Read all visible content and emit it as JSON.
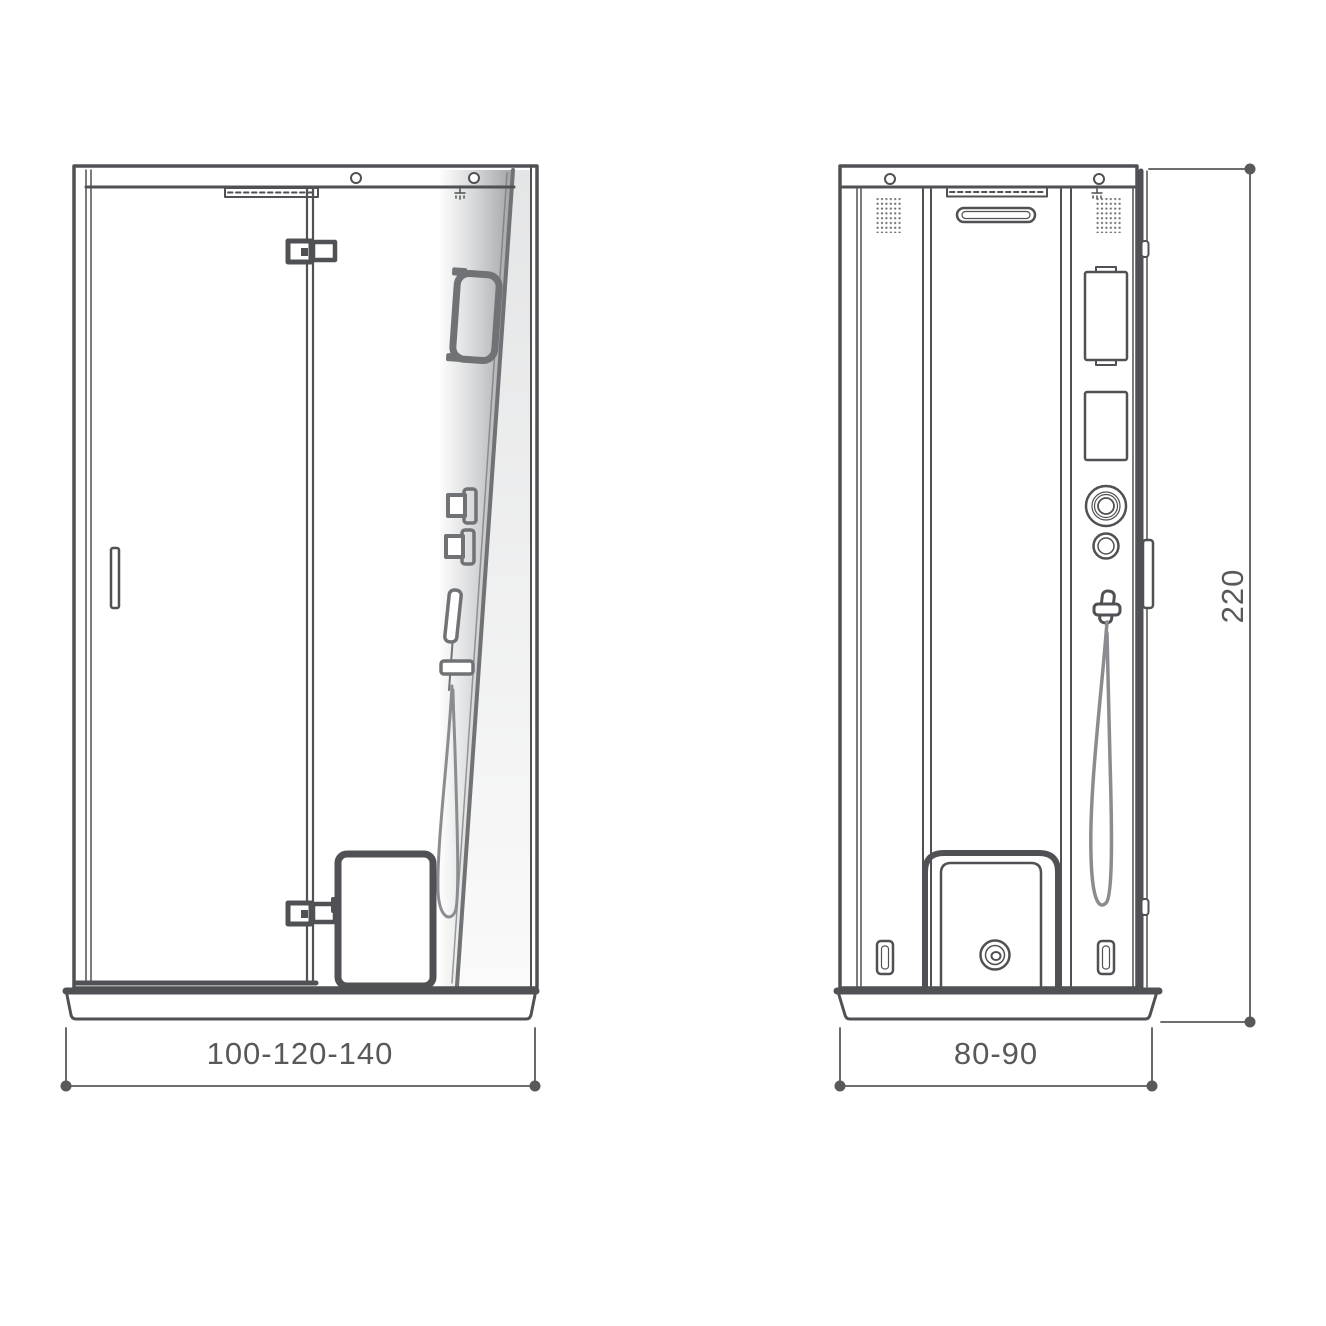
{
  "drawing": {
    "dimensions": {
      "front_width": "100-120-140",
      "side_depth": "80-90",
      "height": "220"
    },
    "colors": {
      "line": "#4f5154",
      "fixture_line": "#707275",
      "dimension": "#58595b",
      "glass_shade": "#9fa1a3",
      "background": "#ffffff"
    },
    "icons": {
      "mounting_hole": "circle",
      "speaker_grille": "dot-grid",
      "drain": "concentric-circles",
      "ceiling_nozzle": "spray-glyph"
    }
  }
}
